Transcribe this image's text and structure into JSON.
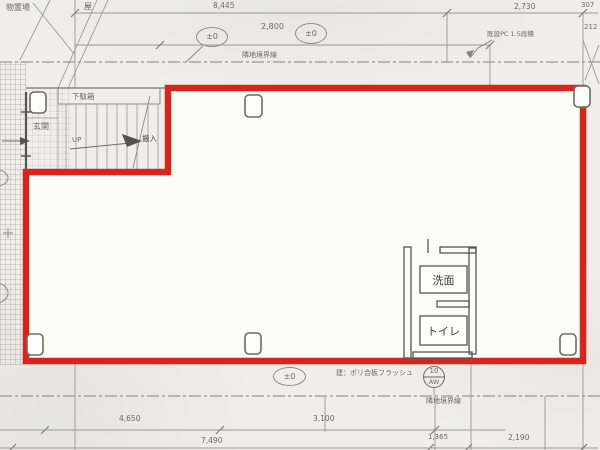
{
  "colors": {
    "outline_red": "#d8241c",
    "paper": "#efeeea",
    "pencil": "#8d8d88"
  },
  "plan": {
    "rooms": {
      "entrance": "玄関",
      "shoe_cabinet": "下駄箱",
      "stair_up": "UP",
      "carry_in": "搬入",
      "washroom": "洗面",
      "toilet": "トイレ"
    },
    "annotations": {
      "storage": "物置場",
      "roof": "屋",
      "boundary_top": "隣地境界線",
      "boundary_bottom": "隣地境界線",
      "existing_wall_note": "既設PC 1.5段積",
      "flush_panel_note": "建：ポリ合板フラッシュ",
      "level_top_left": "±0",
      "level_top_right": "±0",
      "level_bottom": "±0",
      "window_tag_number": "10",
      "window_tag_type": "AW"
    },
    "dimensions": {
      "d8445": "8,445",
      "d2800": "2,800",
      "d2730": "2,730",
      "d307": "307",
      "d212": "212",
      "d4650": "4,650",
      "d3100": "3,100",
      "d7490": "7,490",
      "d1365": "1,365",
      "d2190": "2,190"
    }
  }
}
